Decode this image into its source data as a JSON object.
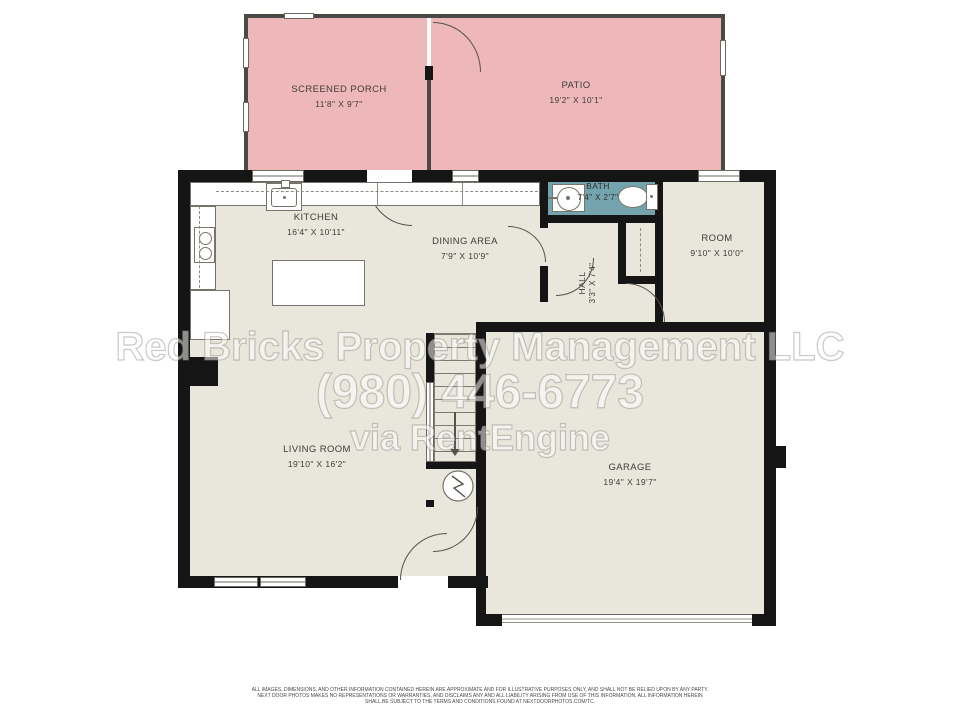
{
  "title": "Residential floor plan",
  "rooms": {
    "screened_porch": {
      "name": "SCREENED PORCH",
      "dims": "11'8\" X 9'7\""
    },
    "patio": {
      "name": "PATIO",
      "dims": "19'2\" X 10'1\""
    },
    "kitchen": {
      "name": "KITCHEN",
      "dims": "16'4\" X 10'11\""
    },
    "dining": {
      "name": "DINING AREA",
      "dims": "7'9\" X 10'9\""
    },
    "bath": {
      "name": "BATH",
      "dims": "7'4\" X 2'7\""
    },
    "hall": {
      "name": "HALL",
      "dims": "3'3\" X 7'4\""
    },
    "room": {
      "name": "ROOM",
      "dims": "9'10\" X 10'0\""
    },
    "living": {
      "name": "LIVING ROOM",
      "dims": "19'10\" X 16'2\""
    },
    "garage": {
      "name": "GARAGE",
      "dims": "19'4\" X 19'7\""
    }
  },
  "watermark": {
    "line1": "Red Bricks Property Management LLC",
    "line2": "(980) 446-6773",
    "line3": "via RentEngine"
  },
  "disclaimer": {
    "lines": [
      "ALL IMAGES, DIMENSIONS, AND OTHER INFORMATION CONTAINED HEREIN ARE APPROXIMATE AND FOR ILLUSTRATIVE PURPOSES ONLY, AND SHALL NOT BE RELIED UPON BY ANY PARTY.",
      "NEXT DOOR PHOTOS MAKES NO REPRESENTATIONS OR WARRANTIES, AND DISCLAIMS ANY AND ALL LIABILITY ARISING FROM USE OF THIS INFORMATION. ALL INFORMATION HEREIN",
      "SHALL BE SUBJECT TO THE TERMS AND CONDITIONS FOUND AT NEXTDOORPHOTOS.COM/TC."
    ]
  },
  "colors": {
    "outdoor_pink": "#eeb7b9",
    "interior_beige": "#e9e6db",
    "bath_teal": "#73a4ad",
    "wall_black": "#151515",
    "thin_wall_gray": "#4b4943"
  }
}
